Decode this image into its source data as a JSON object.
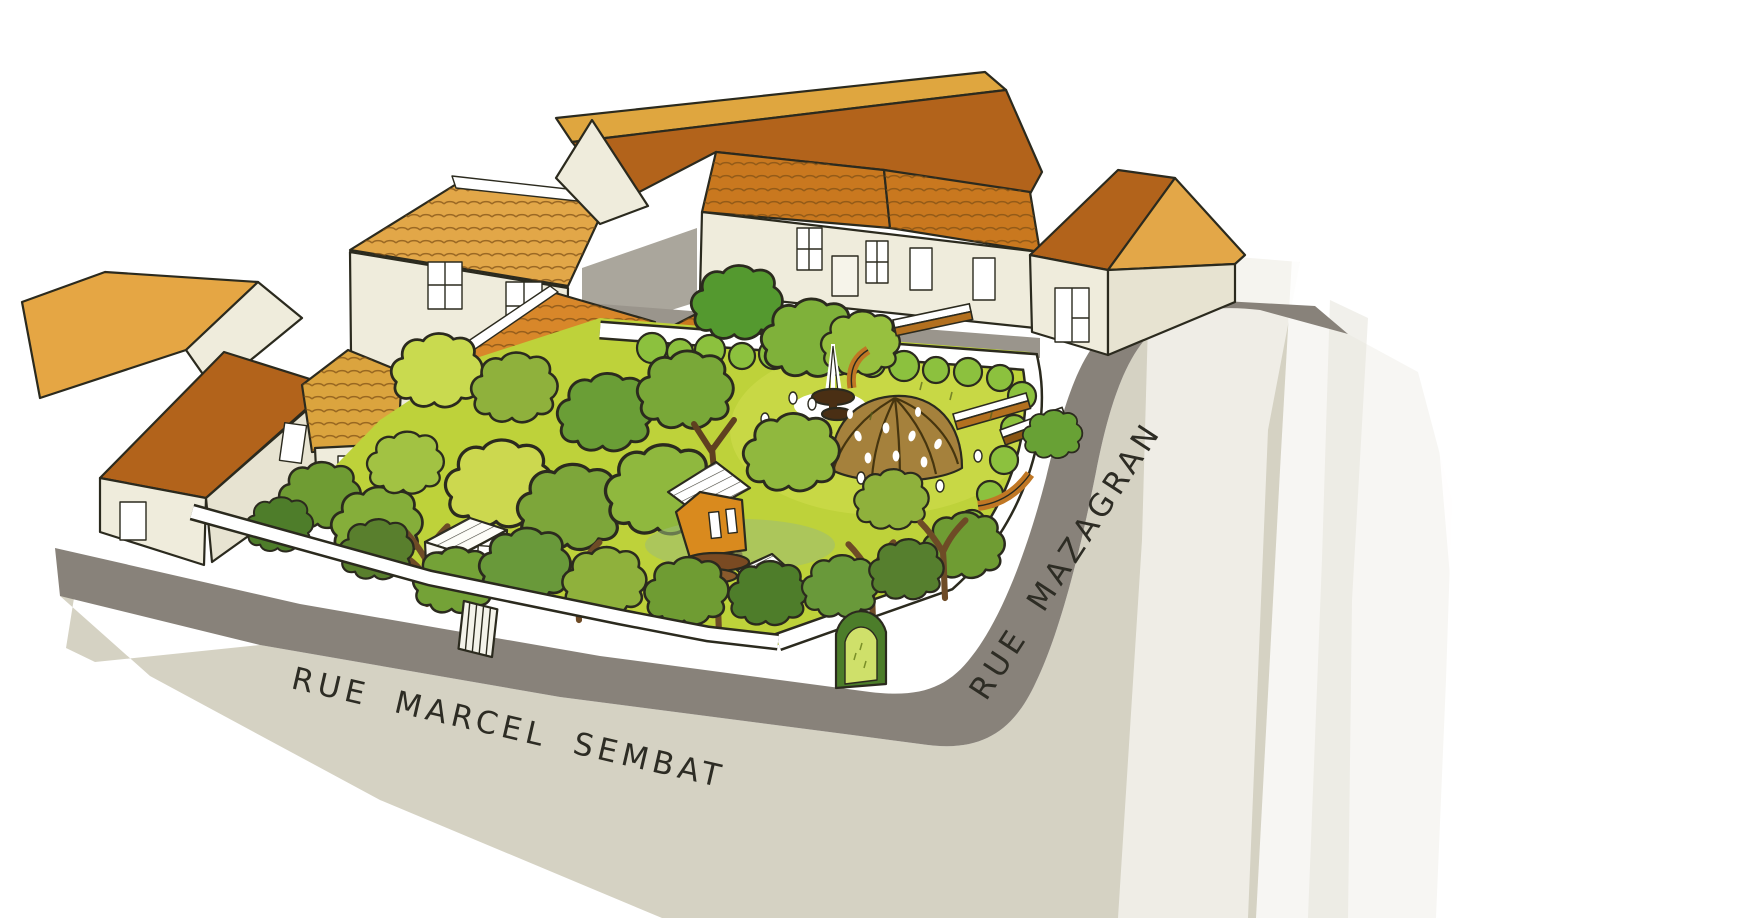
{
  "streets": {
    "rue_marcel_sembat": {
      "label": "RUE MARCEL SEMBAT"
    },
    "rue_mazagran": {
      "label": "RUE MAZAGRAN"
    }
  },
  "scene_elements": [
    "terraced-houses-terracotta-roofs",
    "central-garden-courtyard",
    "garden-trees",
    "woven-dome-pavilion",
    "tiered-fountain",
    "treehouse-cabins",
    "garden-shed",
    "wooden-benches",
    "low-white-garden-wall",
    "wooden-gate",
    "arched-hedge-gateway",
    "street-corner-watercolor-wash"
  ],
  "colors": {
    "background": "#ffffff",
    "sidewalk_beige": "#d5d2c3",
    "road_dark_gray": "#88827a",
    "road_light_gray": "#aaa69c",
    "wall_cream": "#efecdc",
    "wall_cream_shaded": "#e7e3d1",
    "roof_ochre": "#e3a748",
    "roof_dark_orange": "#b2631b",
    "roof_tile_orange": "#c9781f",
    "roof_bright_orange": "#d8872a",
    "lawn_chartreuse": "#bed23a",
    "hedge_green": "#8cc13e",
    "tree_olive": "#8fb13c",
    "tree_mid_green": "#6a9e36",
    "tree_dark_green": "#4e7d2a",
    "tree_light_chartreuse": "#c9da4f",
    "dome_brown": "#a5813c",
    "wood_brown": "#b3701f",
    "treehouse_orange": "#d98a1e",
    "ink_outline": "#2b2a1e",
    "wash_pale": "#eceae2"
  }
}
